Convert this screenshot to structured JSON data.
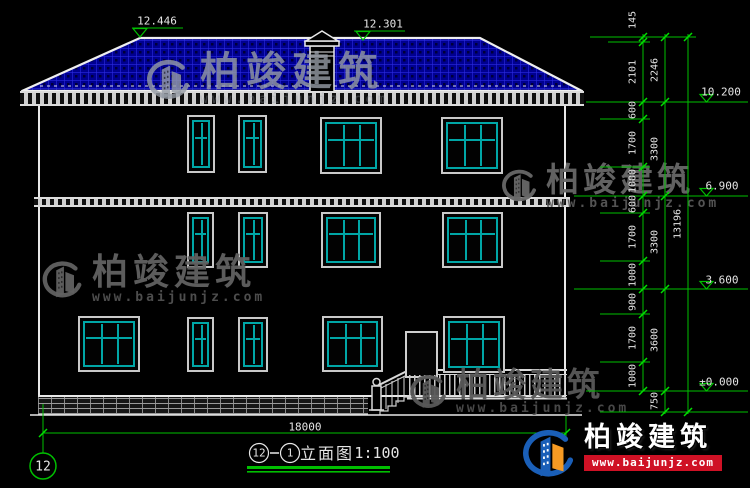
{
  "title_block": {
    "bubble_left": "12",
    "bubble_right": "1",
    "name": "立面图",
    "scale": "1:100"
  },
  "grid_bubble": {
    "label": "12"
  },
  "dims": {
    "top_elevations": [
      "12.446",
      "12.301"
    ],
    "right_segments": [
      "145",
      "2101",
      "600",
      "1700",
      "1000",
      "600",
      "1700",
      "1000",
      "900",
      "1700",
      "1000"
    ],
    "right_floors": [
      "2246",
      "3300",
      "3300",
      "3600",
      "750"
    ],
    "right_total": "13196",
    "right_elevations": [
      "10.200",
      "6.900",
      "3.600",
      "±0.000"
    ],
    "bottom_width": "18000"
  },
  "watermark": {
    "brand": "柏竣建筑",
    "url": "www.baijunjz.com"
  },
  "footer": {
    "brand": "柏竣建筑",
    "url": "www.baijunjz.com"
  },
  "colors": {
    "dimension_green": "#00bf00",
    "roof_blue": "#000090",
    "window_teal": "#00a6a6",
    "brand_red": "#cf1125",
    "brand_blue": "#1a5fb8",
    "brand_orange": "#f59a23"
  }
}
